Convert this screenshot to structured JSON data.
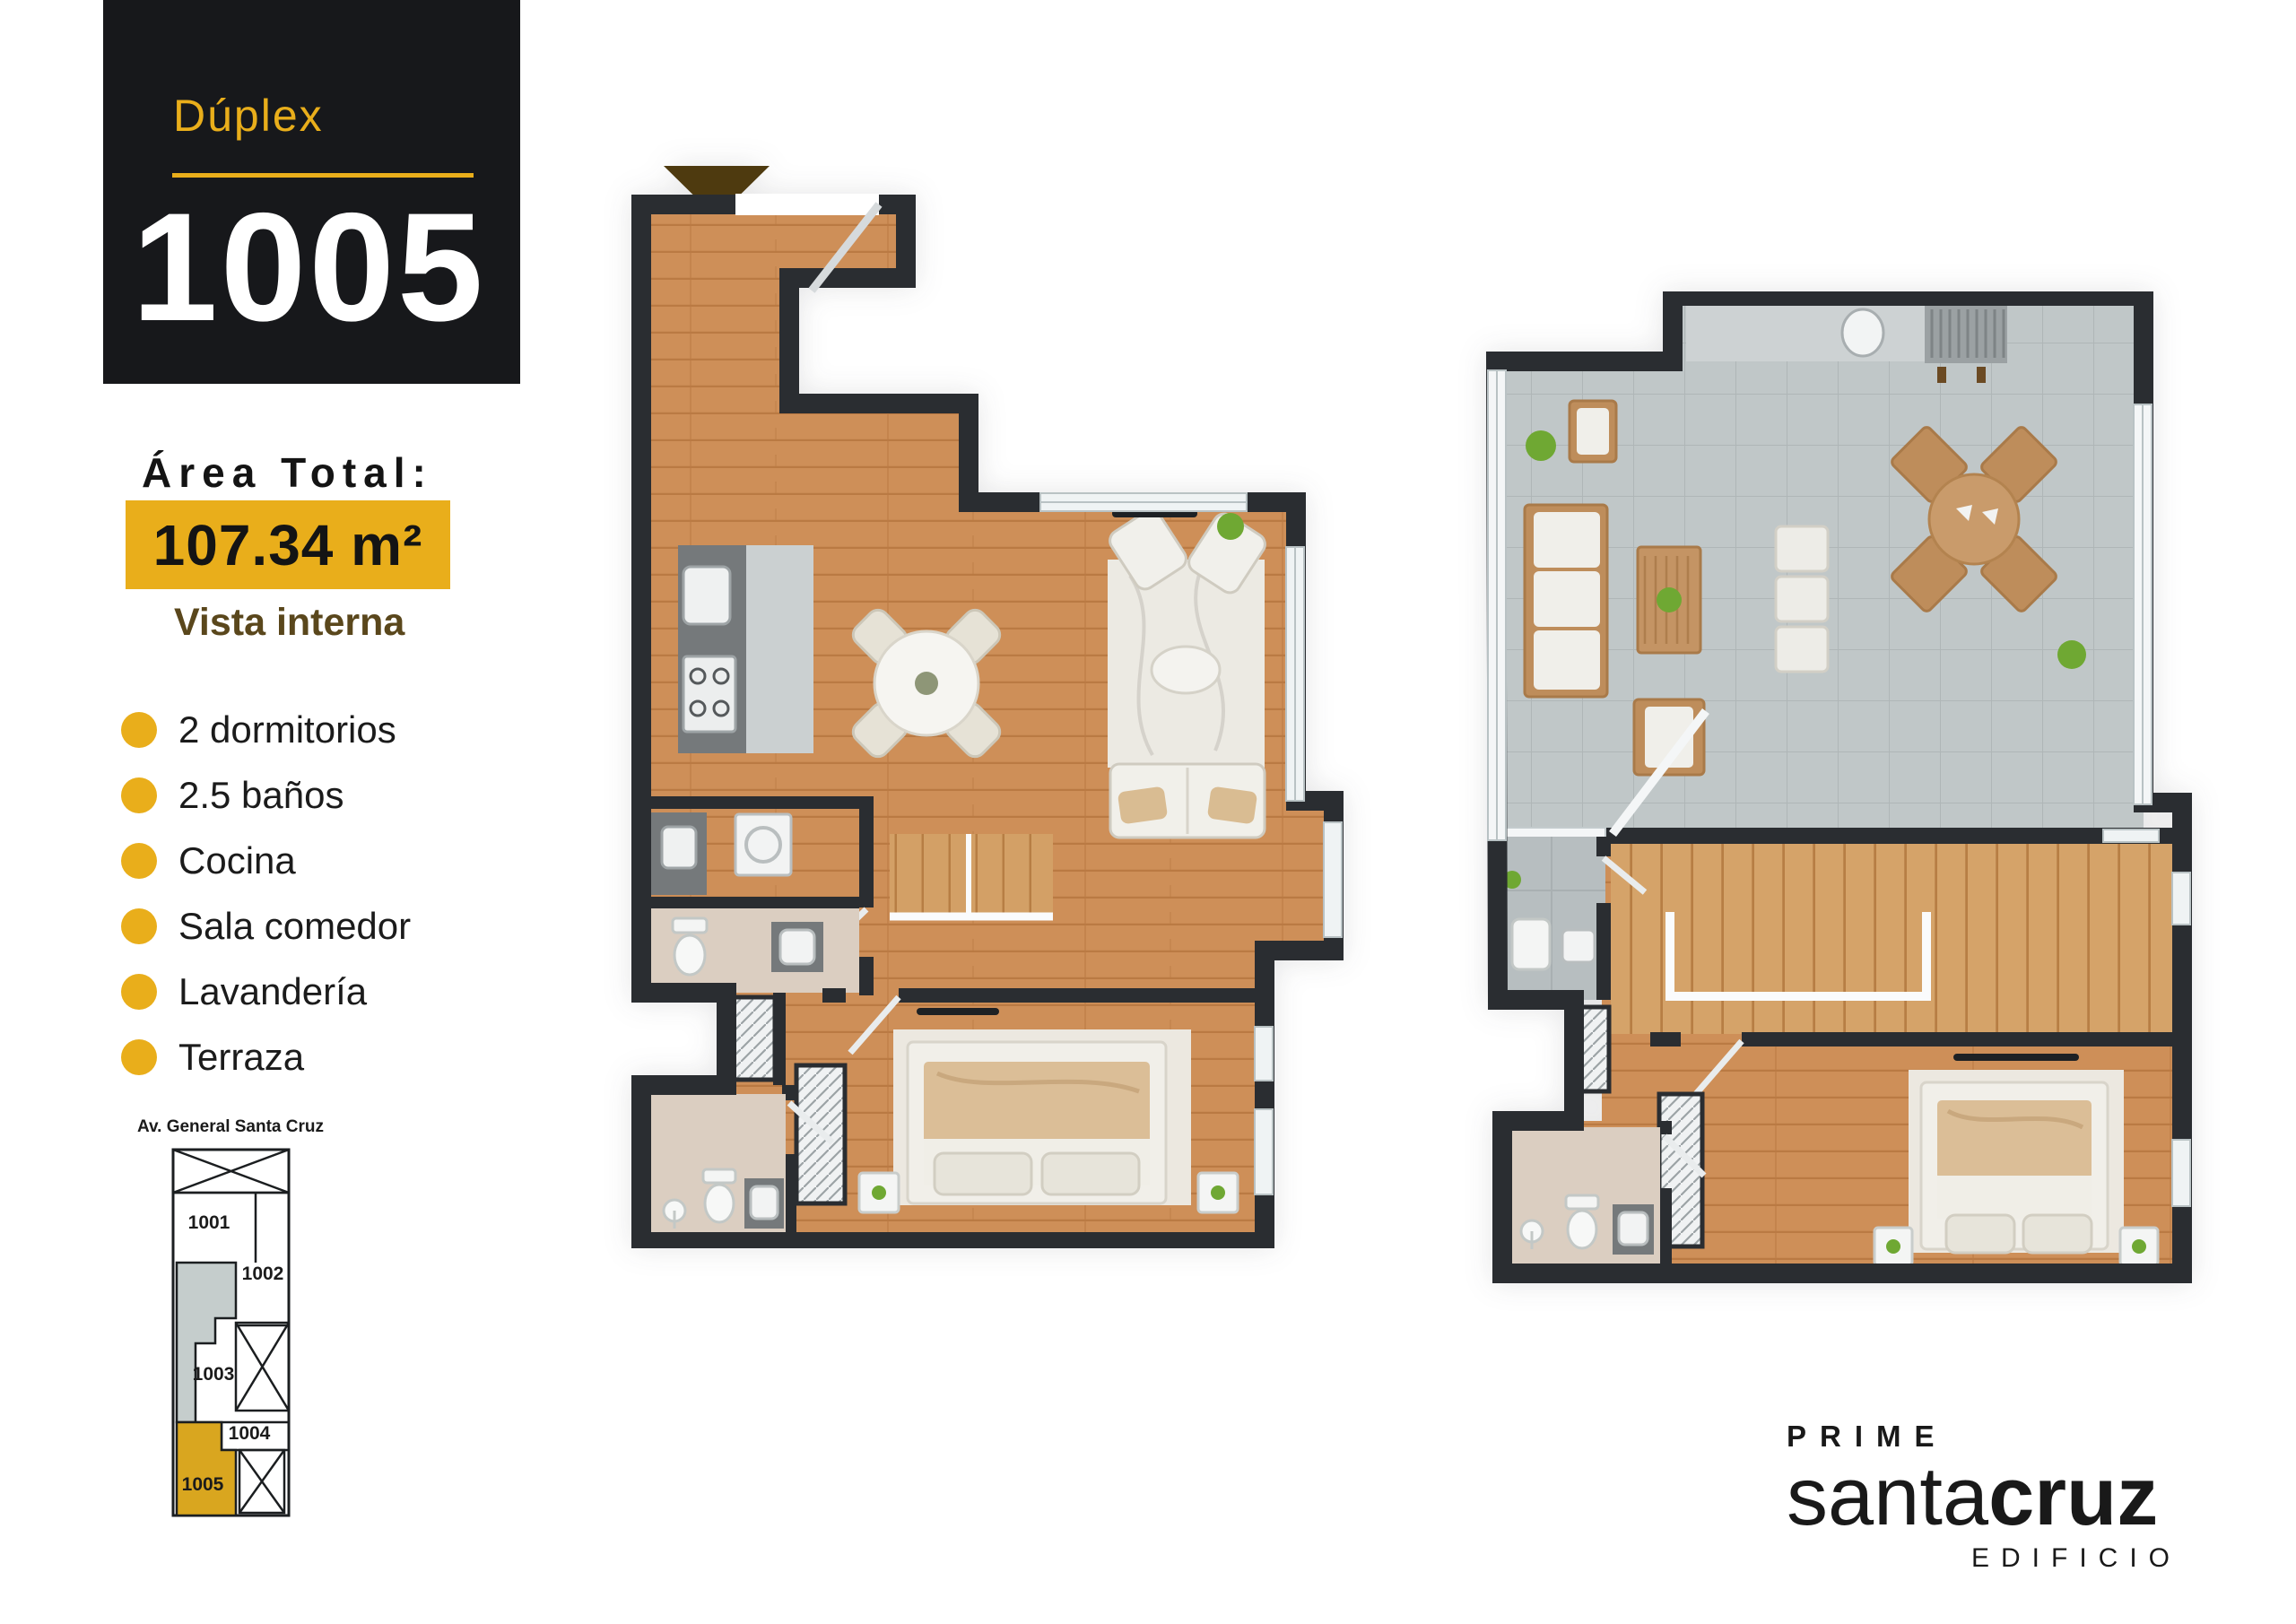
{
  "unit_card": {
    "type_label": "Dúplex",
    "number": "1005"
  },
  "area": {
    "label": "Área Total:",
    "value": "107.34 m²",
    "view_label": "Vista interna"
  },
  "features": [
    "2 dormitorios",
    "2.5 baños",
    "Cocina",
    "Sala comedor",
    "Lavandería",
    "Terraza"
  ],
  "key_plan": {
    "street_label": "Av. General Santa Cruz",
    "units": [
      "1001",
      "1002",
      "1003",
      "1004",
      "1005"
    ],
    "highlighted_unit": "1005"
  },
  "logo": {
    "prime": "PRIME",
    "santa": "santa",
    "cruz": "cruz",
    "edificio": "EDIFICIO"
  },
  "colors": {
    "accent_gold": "#E9AE1B",
    "card_black": "#17181B",
    "wall_dark": "#2A2D31",
    "wood_floor": "#CE8F58",
    "terrace_tile": "#C0C7C8",
    "text_brown": "#5A471C",
    "entry_arrow_brown": "#4E3A0F",
    "keyplan_common_gray": "#C5CDCC"
  }
}
